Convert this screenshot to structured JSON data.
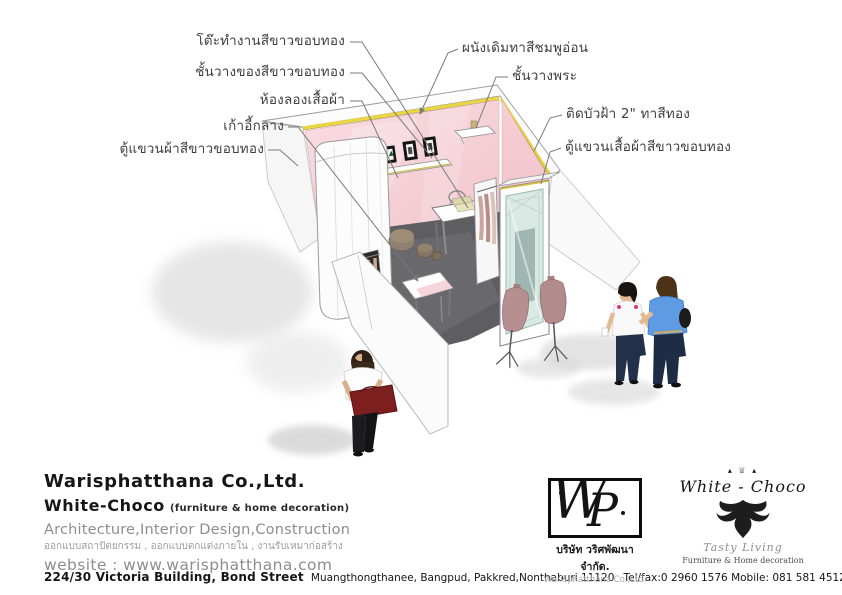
{
  "annotations": {
    "left": [
      {
        "label": "โต๊ะทำงานสีขาวขอบทอง"
      },
      {
        "label": "ชั้นวางของสีขาวขอบทอง"
      },
      {
        "label": "ห้องลองเสื้อผ้า"
      },
      {
        "label": "เก้าอี้กลาง"
      },
      {
        "label": "ตู้แขวนผ้าสีขาวขอบทอง"
      }
    ],
    "right": [
      {
        "label": "ผนังเดิมทาสีชมพูอ่อน"
      },
      {
        "label": "ชั้นวางพระ"
      },
      {
        "label": "ติดบัวฝ้า 2\" ทาสีทอง"
      },
      {
        "label": "ตู้แขวนเสื้อผ้าสีขาวขอบทอง"
      }
    ]
  },
  "footer": {
    "company_en": "Warisphatthana Co.,Ltd.",
    "brand_name": "White-Choco",
    "brand_suffix": "(furniture & home decoration)",
    "services_en": "Architecture,Interior Design,Construction",
    "services_th": "ออกแบบสถาปัตยกรรม , ออกแบบตกแต่งภายใน , งานรับเหมาก่อสร้าง",
    "website": "website : www.warisphatthana.com",
    "address_main": "224/30 Victoria Building, Bond Street",
    "address_detail": "Muangthongthanee, Bangpud, Pakkred,Nonthaburi 11120",
    "telfax": "Tel/fax:0 2960 1576 Mobile: 081 581 4512",
    "email_label": "Email:",
    "email": "piyakarn5@hotmail.com"
  },
  "wp_logo": {
    "monogram_w": "W",
    "monogram_p": "P",
    "company_th": "บริษัท วริศพัฒนา จำกัด.",
    "company_en": "Warisphatthana Co.,Ltd."
  },
  "wc_logo": {
    "crown": "▴ ♕ ▴",
    "name": "White - Choco",
    "tagline": "Tasty Living",
    "subtitle": "Furniture & Home decoration"
  },
  "colors": {
    "wall_pink": "#f6d0d7",
    "gold_trim": "#ecd63e",
    "floor_gray": "#5d5d62",
    "mirror_mint": "#d9e9e3",
    "bag_red": "#7d1f1f",
    "shirt_blue": "#5f9be2"
  }
}
